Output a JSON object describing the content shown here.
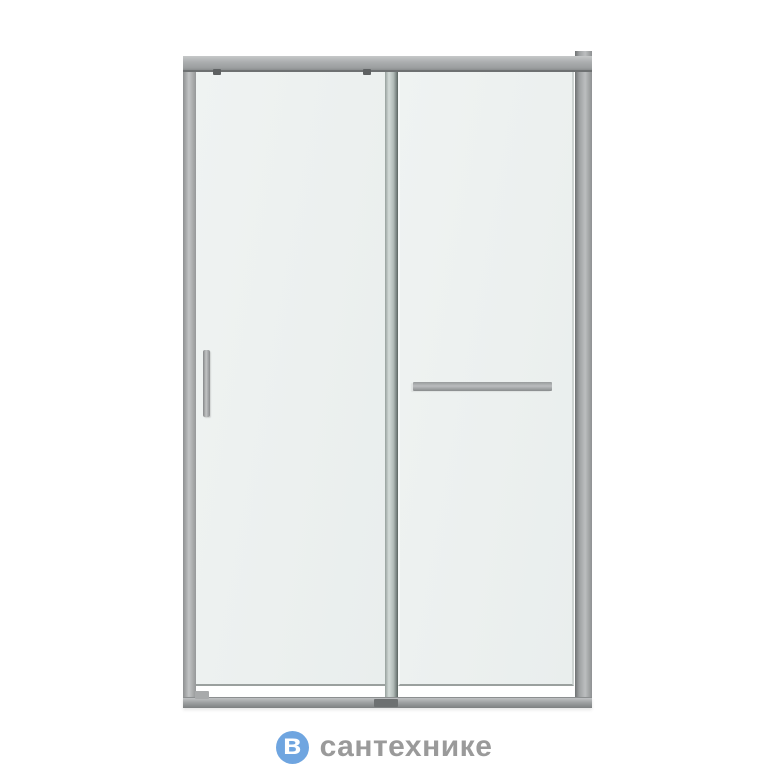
{
  "product_image": {
    "description": "Sliding shower door: grey aluminium frame, two clear glass panels, vertical handle on the sliding left panel, horizontal towel-bar handle on the right fixed panel",
    "colors": {
      "background": "#ffffff",
      "frame_grey": "#a9acad",
      "frame_dark_edge": "#6e7172",
      "glass_tint": "#edf1f0",
      "door_edge_profile": "#b2bcb8",
      "hardware_grey": "#a9abac"
    }
  },
  "watermark": {
    "logo_letter": "в",
    "brand_text": "сантехнике",
    "logo_circle_color": "#6fa5e0",
    "logo_letter_color": "#ffffff",
    "text_color": "#9a9a9a"
  }
}
